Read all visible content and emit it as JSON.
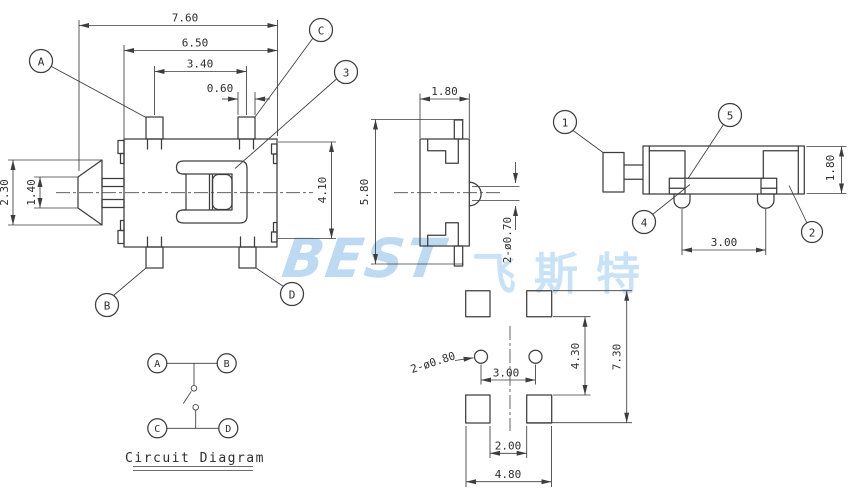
{
  "watermark": {
    "latin": "BEST",
    "cjk": "飞斯特"
  },
  "front": {
    "d_overall_w": "7.60",
    "d_body_w": "6.50",
    "d_pin_pitch": "3.40",
    "d_pad_w": "0.60",
    "d_knob_h": "2.30",
    "d_knob_tip_h": "1.40",
    "d_inner_h": "4.10",
    "d_overall_h": "5.80"
  },
  "side": {
    "d_width": "1.80",
    "d_pin_dia": "2-ø0.70"
  },
  "end": {
    "d_height": "1.80",
    "d_pin_pitch": "3.00"
  },
  "pcb": {
    "d_hole": "2-ø0.80",
    "d_hole_pitch": "3.00",
    "d_pad_gap_v": "4.30",
    "d_total_h": "7.30",
    "d_pad_gap_h": "2.00",
    "d_total_w": "4.80"
  },
  "callouts": {
    "A": "A",
    "B": "B",
    "C": "C",
    "D": "D",
    "n1": "1",
    "n2": "2",
    "n3": "3",
    "n4": "4",
    "n5": "5"
  },
  "circuit": {
    "title": "Circuit Diagram",
    "t_a": "A",
    "t_b": "B",
    "t_c": "C",
    "t_d": "D"
  }
}
